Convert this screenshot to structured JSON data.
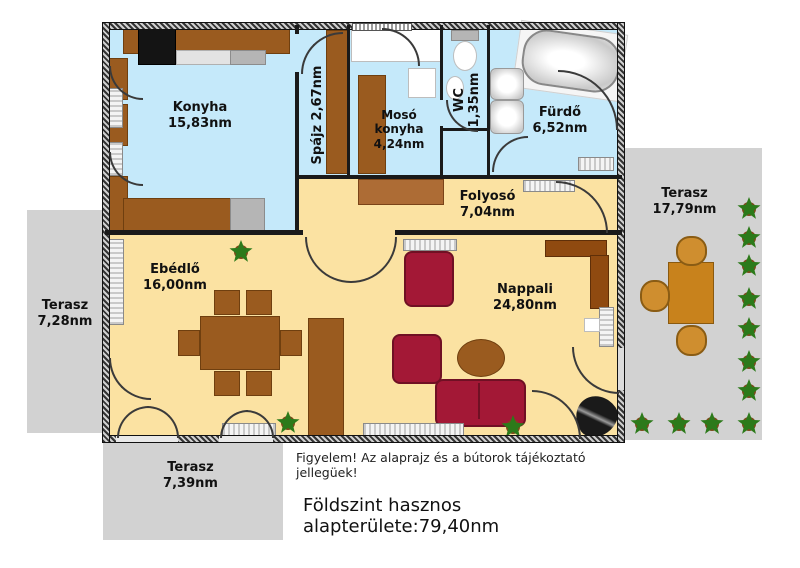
{
  "rooms": [
    {
      "name": "Konyha",
      "area": "15,83nm"
    },
    {
      "name": "Spájz",
      "area": "2,67nm"
    },
    {
      "name": "Mosó konyha",
      "area": "4,24nm"
    },
    {
      "name": "WC",
      "area": "1,35nm"
    },
    {
      "name": "Fürdő",
      "area": "6,52nm"
    },
    {
      "name": "Folyosó",
      "area": "7,04nm"
    },
    {
      "name": "Ebédlő",
      "area": "16,00nm"
    },
    {
      "name": "Nappali",
      "area": "24,80nm"
    }
  ],
  "terraces": [
    {
      "name": "Terasz",
      "area": "17,79nm"
    },
    {
      "name": "Terasz",
      "area": "7,28nm"
    },
    {
      "name": "Terasz",
      "area": "7,39nm"
    }
  ],
  "notes": {
    "disclaimer": "Figyelem! Az alaprajz és a bútorok tájékoztató jellegüek!",
    "total_area_label": "Földszint hasznos alapterülete:79,40nm"
  },
  "colors": {
    "wet_room_floor": "#c5e9fa",
    "living_floor": "#fbe2a2",
    "terrace": "#d2d2d2",
    "furniture_brown": "#9a5b1f",
    "sofa_red": "#a31836",
    "wall": "#1a1a1a"
  }
}
